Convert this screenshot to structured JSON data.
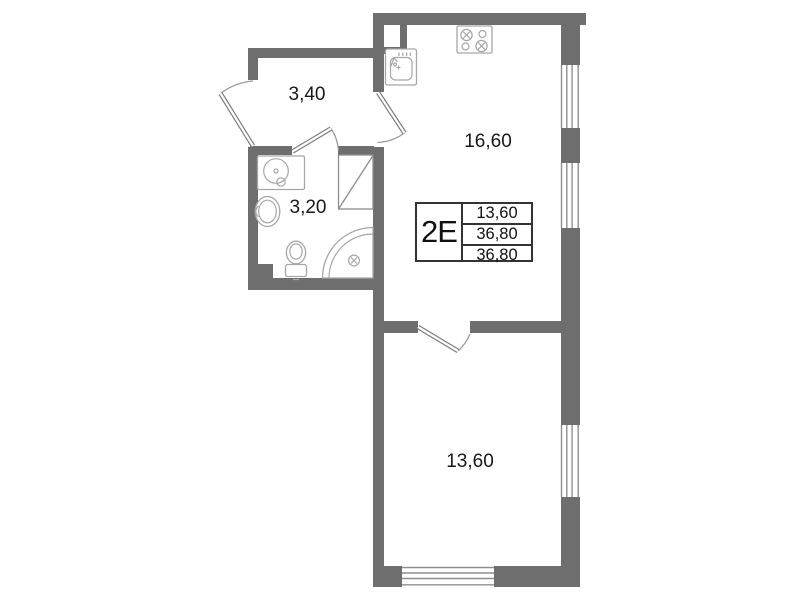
{
  "plan": {
    "title": "apartment-floor-plan",
    "info_table": {
      "unit_label": "2Е",
      "rows": [
        {
          "value": "13,60"
        },
        {
          "value": "36,80"
        },
        {
          "value": "36,80"
        }
      ]
    },
    "rooms": [
      {
        "name": "hallway",
        "area": "3,40"
      },
      {
        "name": "bathroom",
        "area": "3,20"
      },
      {
        "name": "kitchen-living-room",
        "area": "16,60"
      },
      {
        "name": "bedroom",
        "area": "13,60"
      }
    ],
    "colors": {
      "wall": "#6e6e6e",
      "window_line": "#8f8f8f",
      "fixture_line": "#a6a6a6",
      "door_arc": "#9b9b9b",
      "table_border": "#333333",
      "text": "#1a1a1a",
      "background": "#ffffff"
    },
    "icons": [
      "stove-icon",
      "kitchen-sink-icon",
      "washing-machine-icon",
      "bathroom-sink-icon",
      "toilet-icon",
      "shower-icon",
      "wardrobe-icon",
      "window-icon",
      "door-swing-icon"
    ]
  }
}
